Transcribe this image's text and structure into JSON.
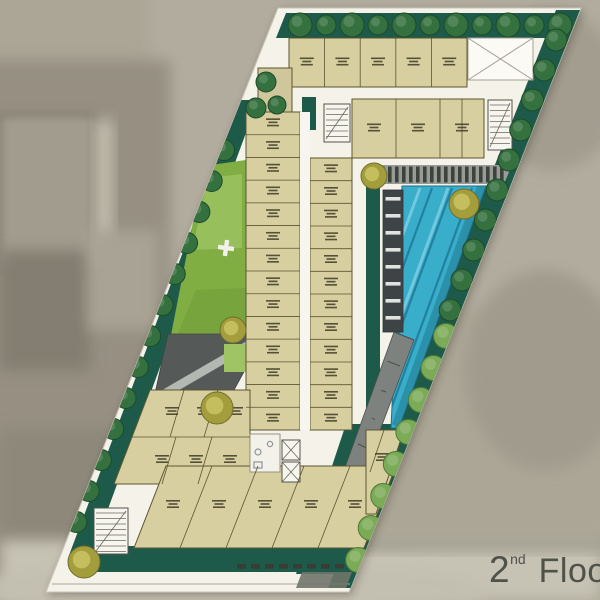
{
  "floor_label": {
    "number": "2",
    "ordinal": "nd",
    "word": "Floor"
  },
  "palette": {
    "site": "#f4f2e9",
    "building": "#d7cf9f",
    "building_outline": "#5c5530",
    "landscape_dark": "#1d5a49",
    "tree_dark": "#35703f",
    "tree_light": "#7cab57",
    "tree_olive": "#a49d3c",
    "lawn": "#80ae43",
    "lawn_light": "#9fc463",
    "pool": "#38aeca",
    "pool_lane": "#20789a",
    "deck_dark": "#3e4345",
    "roof_dark": "#555a58",
    "path_gray": "#b3b8b3",
    "text_gray": "#50524a",
    "background": "#aba696"
  }
}
